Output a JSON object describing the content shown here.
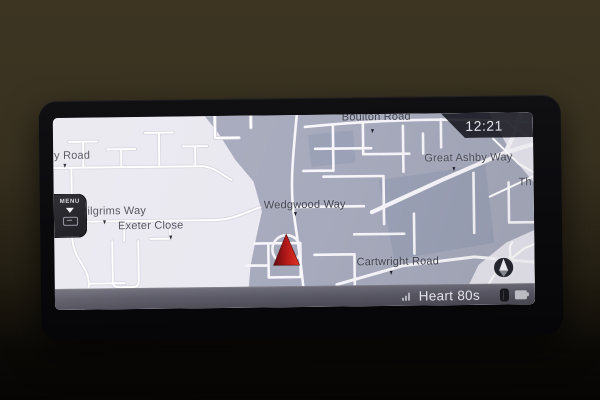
{
  "screen": {
    "clock": "12:21",
    "menu": {
      "label": "MENU"
    },
    "status_bar": {
      "station_name": "Heart 80s"
    },
    "map": {
      "road_labels": [
        {
          "text": "ry Road"
        },
        {
          "text": "Pilgrims Way"
        },
        {
          "text": "Exeter Close"
        },
        {
          "text": "Wedgwood Way"
        },
        {
          "text": "Boulton Road"
        },
        {
          "text": "Great Ashby Way"
        },
        {
          "text": "Cartwright Road"
        },
        {
          "text": "Th"
        }
      ]
    },
    "icons": {
      "menu_arrow": "chevron-down",
      "menu_mini": "page-outline",
      "compass": "compass-north-needle",
      "vehicle": "vehicle-position-triangle",
      "radio_signal": "signal-bars",
      "bluetooth": "bluetooth",
      "battery": "battery"
    },
    "colors": {
      "map_light": "#eae8f0",
      "map_dark": "#a6aabc",
      "road_white": "#f7f6fa",
      "vehicle_red": "#c22018",
      "status_bar_gray": "#5c5b66",
      "clock_badge": "#15151c"
    }
  }
}
